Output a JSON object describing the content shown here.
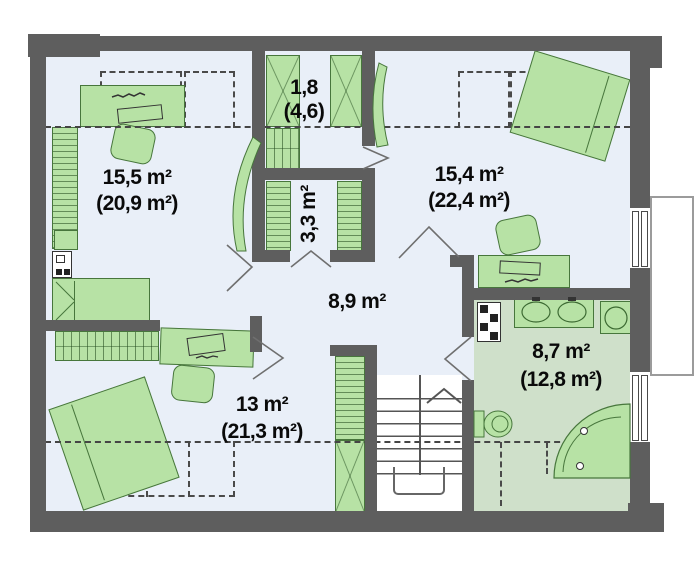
{
  "rooms": [
    {
      "name": "bedroom-top-left",
      "area": "15,5 m²",
      "floor_area": "(20,9 m²)"
    },
    {
      "name": "closet-top",
      "area": "1,8",
      "floor_area": "(4,6)"
    },
    {
      "name": "wardrobe-closet",
      "area": "3,3 m²"
    },
    {
      "name": "bedroom-top-right",
      "area": "15,4 m²",
      "floor_area": "(22,4 m²)"
    },
    {
      "name": "hall",
      "area": "8,9 m²"
    },
    {
      "name": "bedroom-bottom-left",
      "area": "13 m²",
      "floor_area": "(21,3 m²)"
    },
    {
      "name": "bathroom",
      "area": "8,7 m²",
      "floor_area": "(12,8 m²)"
    }
  ],
  "colors": {
    "wall": "#5e5e5e",
    "floor": "#e9eff8",
    "bathroom_floor": "#cfe0ca",
    "furniture": "#b7e2a5",
    "furniture_border": "#47763c"
  }
}
